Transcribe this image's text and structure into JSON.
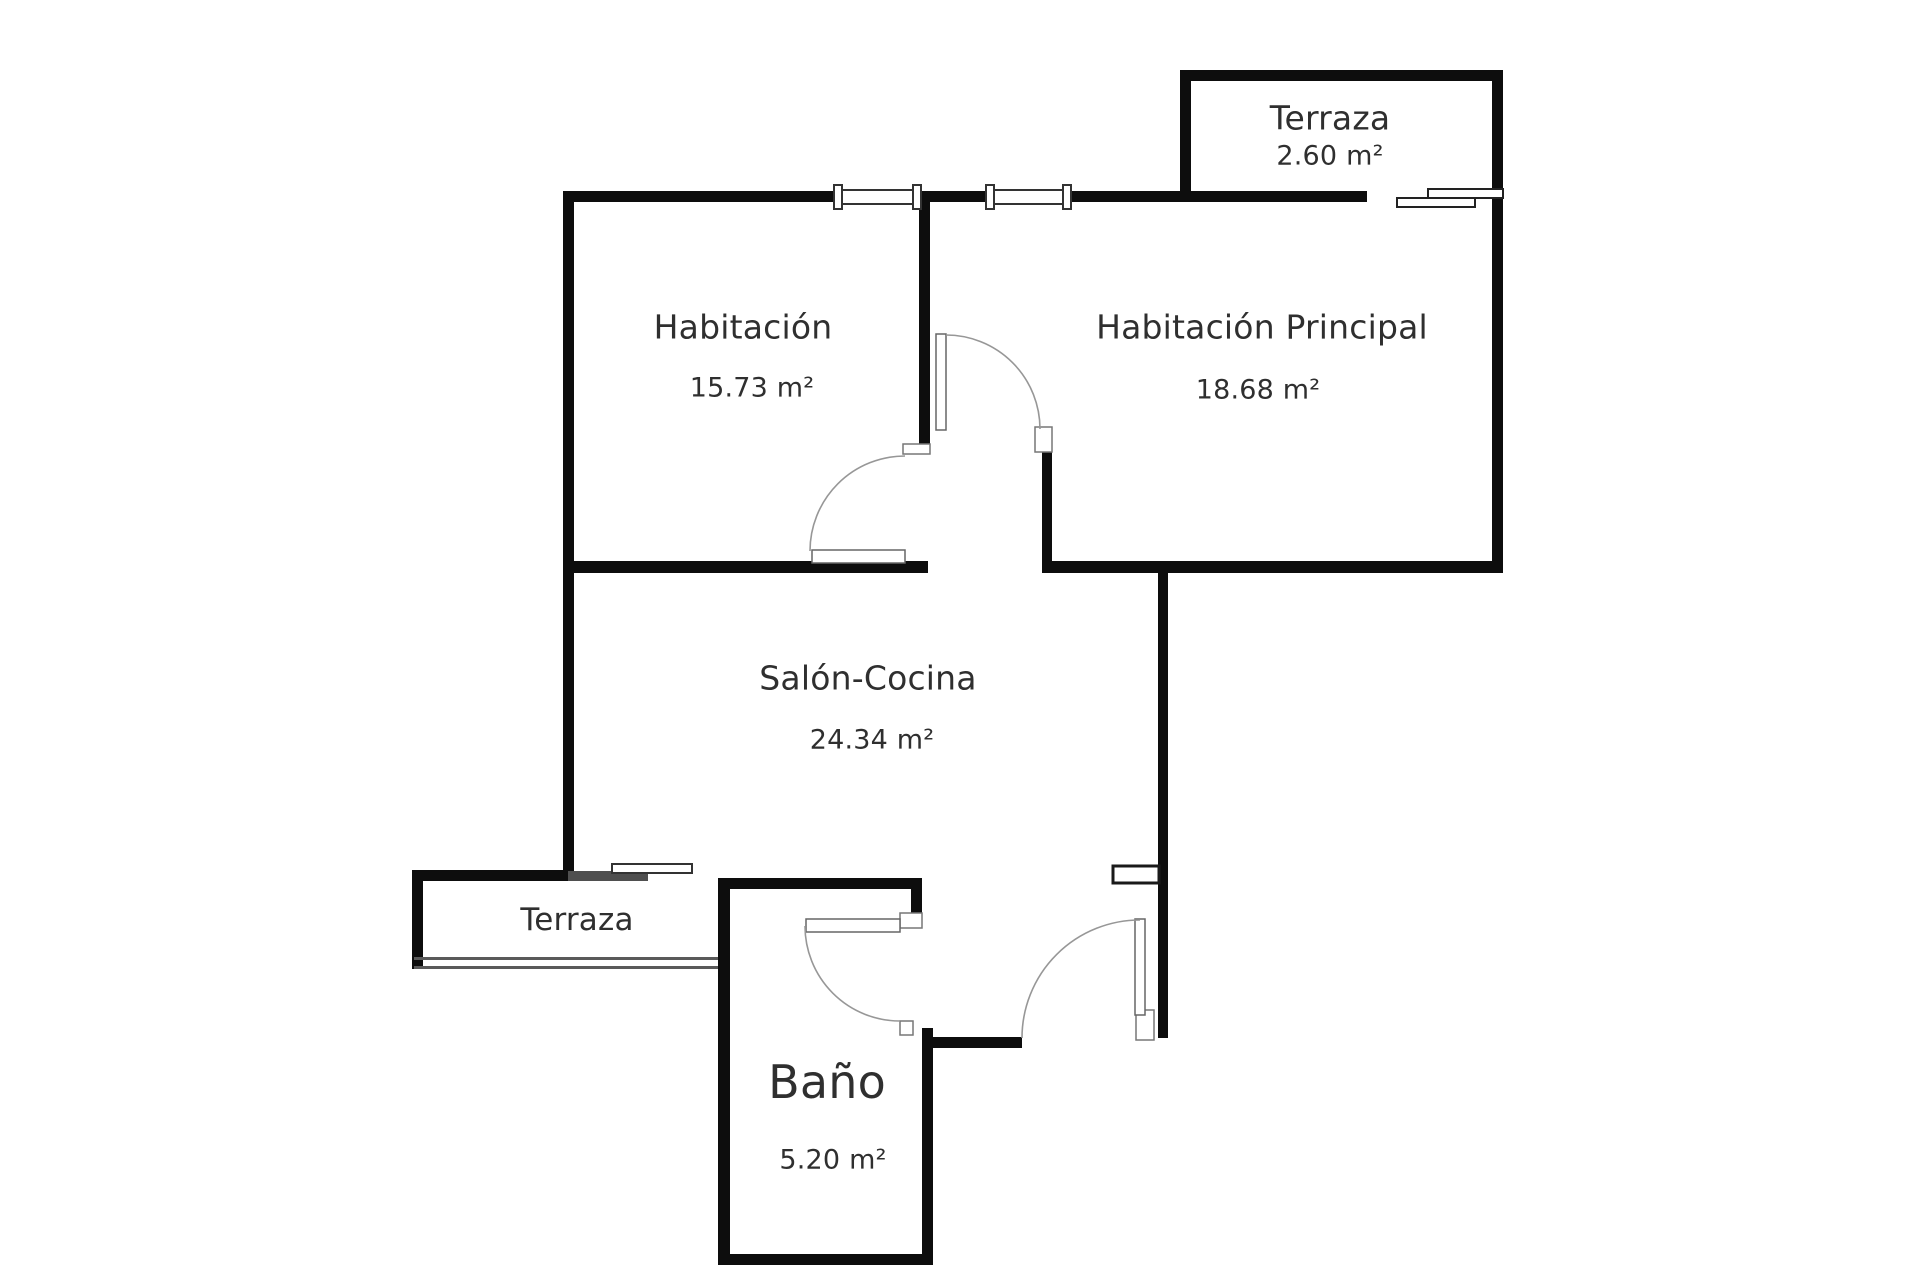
{
  "theme": {
    "wall_color": "#0d0d0d",
    "thin_line_color": "#5a5a5a",
    "arc_color": "#979797",
    "window_frame_color": "#6e6e6e",
    "text_color": "#2f2f2f",
    "background": "#ffffff"
  },
  "rooms": [
    {
      "id": "terraza-top",
      "name": "Terraza",
      "area": "2.60 m²"
    },
    {
      "id": "habitacion",
      "name": "Habitación",
      "area": "15.73 m²"
    },
    {
      "id": "habitacion-principal",
      "name": "Habitación Principal",
      "area": "18.68 m²"
    },
    {
      "id": "salon-cocina",
      "name": "Salón-Cocina",
      "area": "24.34 m²"
    },
    {
      "id": "terraza-bottom",
      "name": "Terraza",
      "area": ""
    },
    {
      "id": "bano",
      "name": "Baño",
      "area": "5.20 m²"
    }
  ],
  "symbols": {
    "window": "window-symbol",
    "sliding_door": "sliding-door-symbol",
    "door_swing": "door-swing-arc"
  }
}
